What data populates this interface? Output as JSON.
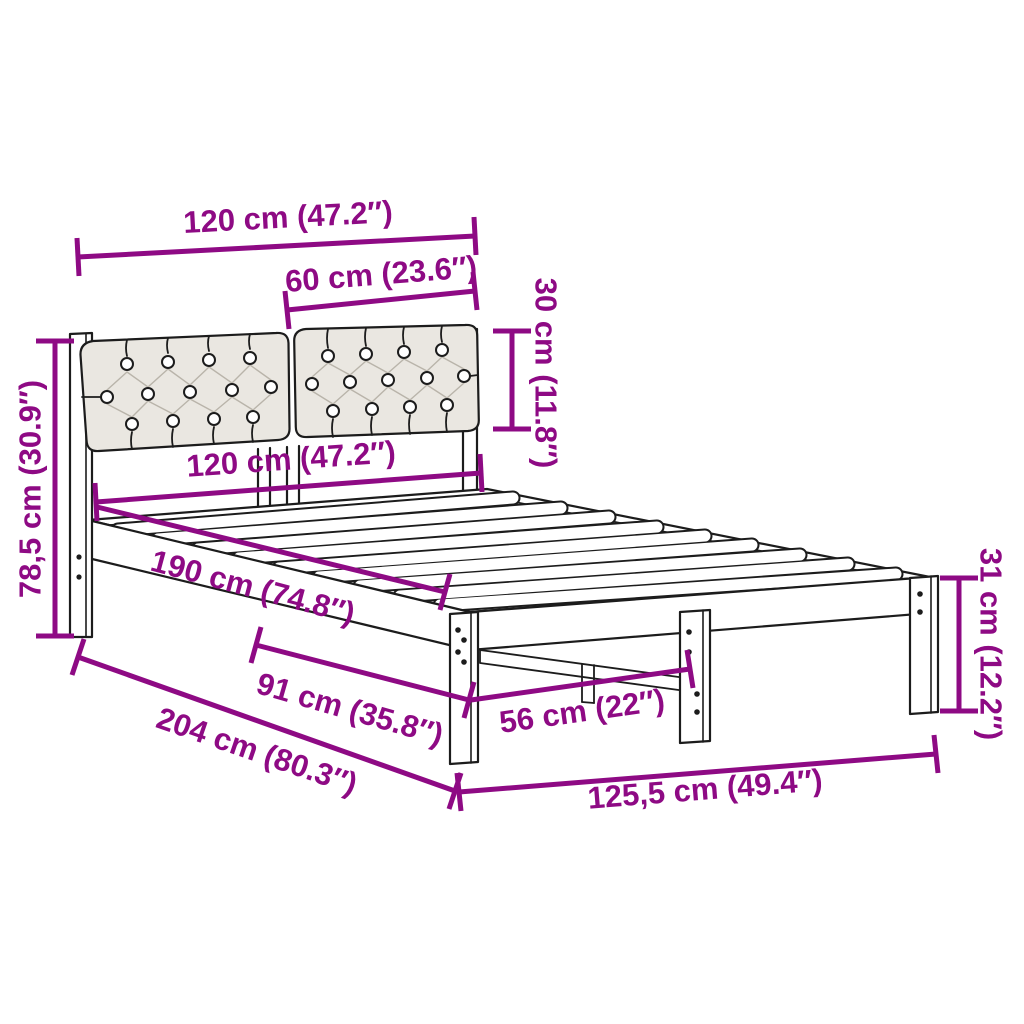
{
  "diagram": {
    "kind": "product-dimension-diagram",
    "product": "bed-frame-with-tufted-headboard",
    "background_color": "#FFFFFF",
    "line_art_color": "#1C1C1C",
    "dimension_color": "#8E0A84",
    "cushion_fill_color": "#EAE7E1",
    "dimensions": [
      {
        "id": "headboard-width-top",
        "label": "120 cm (47.2″)"
      },
      {
        "id": "cushion-width",
        "label": "60 cm (23.6″)"
      },
      {
        "id": "cushion-height",
        "label": "30 cm (11.8″)"
      },
      {
        "id": "frame-width",
        "label": "120 cm (47.2″)"
      },
      {
        "id": "headboard-height",
        "label": "78,5 cm (30.9″)"
      },
      {
        "id": "slat-length",
        "label": "190 cm (74.8″)"
      },
      {
        "id": "side-leg-spacing",
        "label": "91 cm (35.8″)"
      },
      {
        "id": "total-length",
        "label": "204 cm (80.3″)"
      },
      {
        "id": "foot-leg-spacing",
        "label": "56 cm (22″)"
      },
      {
        "id": "frame-height",
        "label": "31 cm (12.2″)"
      },
      {
        "id": "total-width",
        "label": "125,5 cm (49.4″)"
      }
    ]
  }
}
